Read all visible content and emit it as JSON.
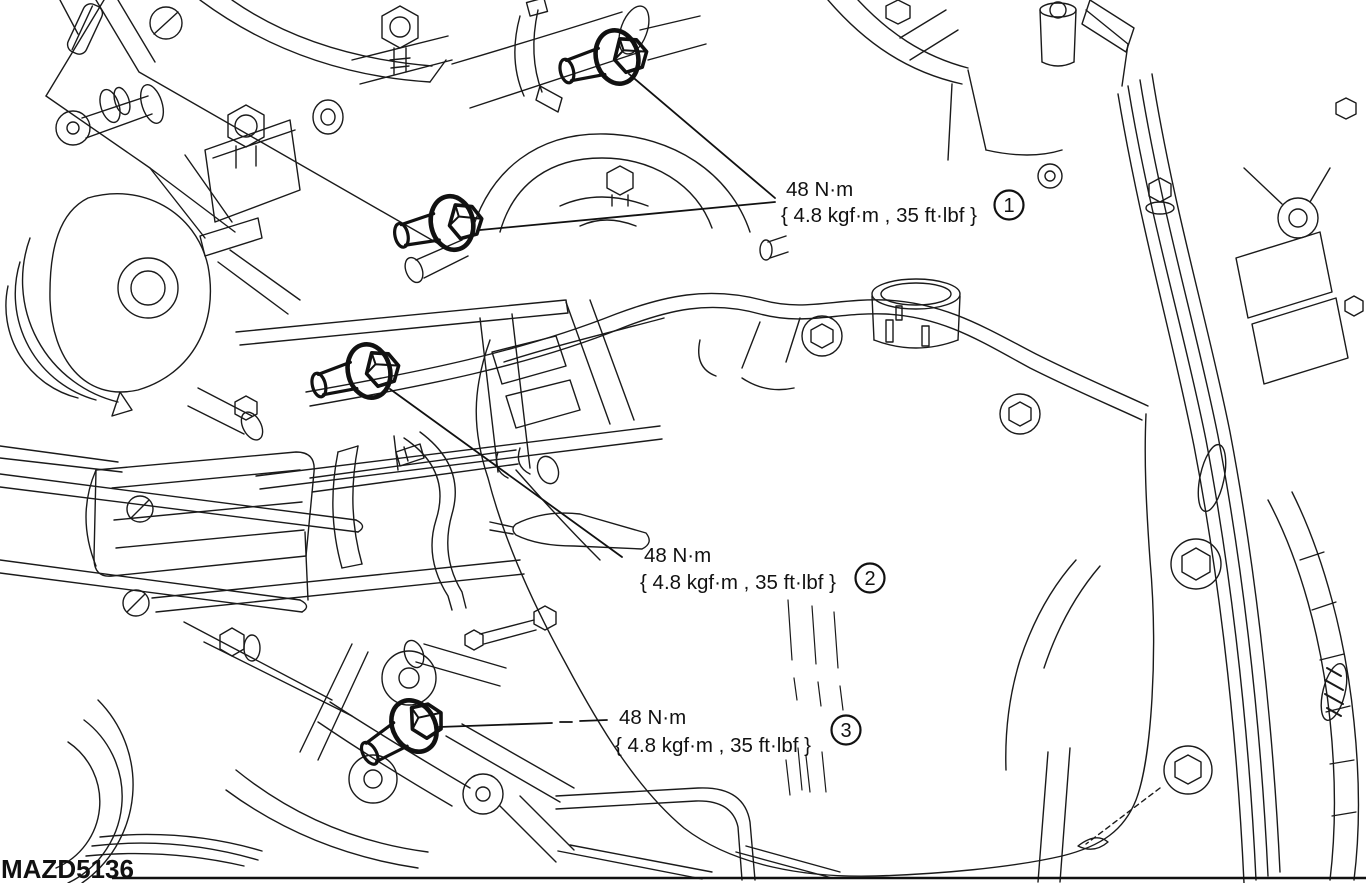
{
  "figure": {
    "code": "MAZD5136",
    "description": "Engine / transaxle mount bolt torque specification line drawing",
    "background_color": "#ffffff",
    "line_color": "#1a1a1a"
  },
  "callouts": [
    {
      "number": "1",
      "torque_primary": "48 N·m",
      "torque_secondary": "{ 4.8 kgf·m , 35 ft·lbf }"
    },
    {
      "number": "2",
      "torque_primary": "48 N·m",
      "torque_secondary": "{ 4.8 kgf·m , 35 ft·lbf }"
    },
    {
      "number": "3",
      "torque_primary": "48 N·m",
      "torque_secondary": "{ 4.8 kgf·m , 35 ft·lbf }"
    }
  ]
}
